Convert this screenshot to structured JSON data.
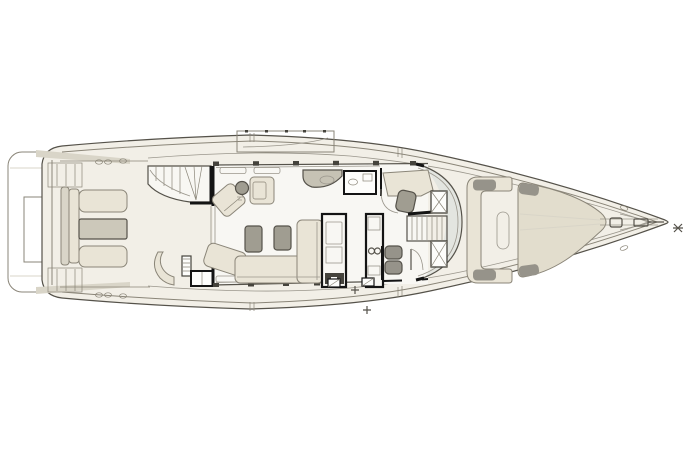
{
  "canvas": {
    "width": 699,
    "height": 466,
    "background": "#ffffff"
  },
  "diagram": {
    "type": "yacht-main-deck-floor-plan",
    "orientation": "bow-right",
    "visible_text": "",
    "zones": [
      "swim-platform",
      "aft-cockpit",
      "flybridge-stairs",
      "salon",
      "galley",
      "helm-station",
      "companionway-stairs",
      "foredeck-lounge",
      "bow-sun-pad",
      "anchor-windlass"
    ]
  },
  "colors": {
    "background": "#ffffff",
    "deck": "#f2efe7",
    "floor": "#f8f7f3",
    "furniture": "#e9e4d6",
    "furniture_dark": "#ccc8ba",
    "cushion_gray": "#a09d91",
    "pad_gray": "#96938a",
    "sideboard": "#c6c2b4",
    "sunpad": "#e2ddcd",
    "glass": "#e3e5e0",
    "white": "#fdfdfb",
    "band": "#d9d5c8",
    "dark_block": "#45433c",
    "outline": "#55524a",
    "line_mid": "#8a8578",
    "line_light": "#9a968c",
    "wall": "#141414"
  }
}
